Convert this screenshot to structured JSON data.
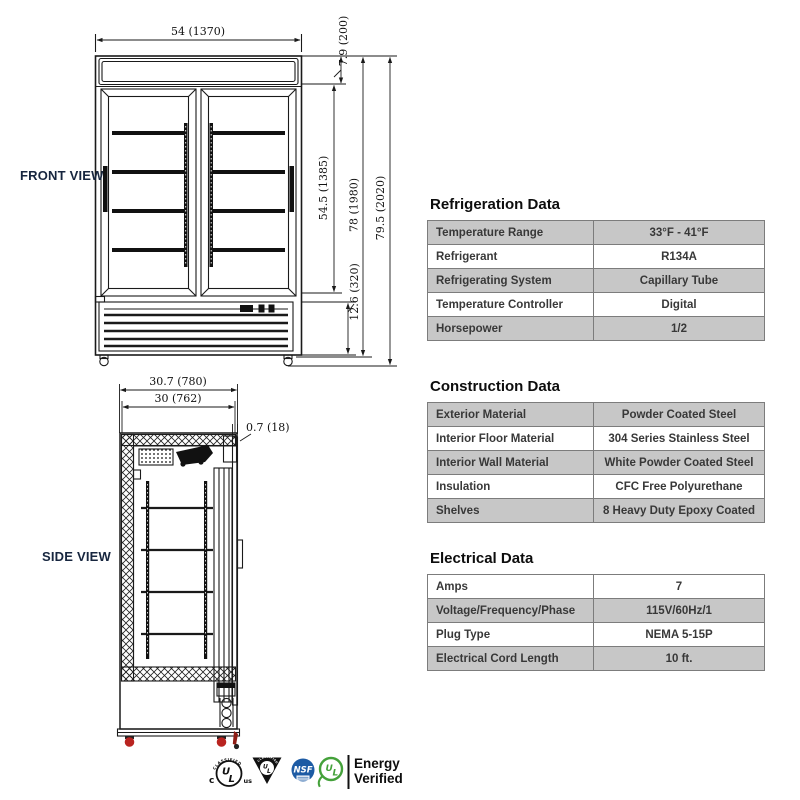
{
  "views": {
    "front": {
      "label": "FRONT VIEW",
      "dims": {
        "width": "54 (1370)",
        "header_height": "7.9 (200)",
        "door_section_height": "54.5 (1385)",
        "cabinet_height": "78 (1980)",
        "overall_height": "79.5 (2020)",
        "bottom_section_height": "12.6 (320)"
      }
    },
    "side": {
      "label": "SIDE VIEW",
      "dims": {
        "overall_depth": "30.7 (780)",
        "body_depth": "30 (762)",
        "door_thickness": "0.7 (18)"
      }
    }
  },
  "tables": [
    {
      "title": "Refrigeration Data",
      "rows": [
        {
          "label": "Temperature Range",
          "value": "33°F - 41°F"
        },
        {
          "label": "Refrigerant",
          "value": "R134A"
        },
        {
          "label": "Refrigerating System",
          "value": "Capillary Tube"
        },
        {
          "label": "Temperature Controller",
          "value": "Digital"
        },
        {
          "label": "Horsepower",
          "value": "1/2"
        }
      ]
    },
    {
      "title": "Construction Data",
      "rows": [
        {
          "label": "Exterior Material",
          "value": "Powder Coated Steel"
        },
        {
          "label": "Interior Floor Material",
          "value": "304 Series Stainless Steel"
        },
        {
          "label": "Interior Wall Material",
          "value": "White Powder Coated Steel"
        },
        {
          "label": "Insulation",
          "value": "CFC Free Polyurethane"
        },
        {
          "label": "Shelves",
          "value": "8 Heavy Duty Epoxy Coated"
        }
      ]
    },
    {
      "title": "Electrical Data",
      "rows": [
        {
          "label": "Amps",
          "value": "7"
        },
        {
          "label": "Voltage/Frequency/Phase",
          "value": "115V/60Hz/1"
        },
        {
          "label": "Plug Type",
          "value": "NEMA 5-15P"
        },
        {
          "label": "Electrical Cord Length",
          "value": "10 ft."
        }
      ]
    }
  ],
  "certifications": {
    "ul_classified": {
      "arc_text": "CLASSIFIED",
      "left": "c",
      "right": "us",
      "mark_u": "U",
      "mark_l": "L"
    },
    "ul_triangle": {
      "arc_text": "CLASSIFIED",
      "mark_u": "U",
      "mark_l": "L"
    },
    "nsf": {
      "mark": "NSF"
    },
    "ul_energy": {
      "mark_u": "U",
      "mark_l": "L",
      "line1": "Energy",
      "line2": "Verified"
    }
  },
  "colors": {
    "table_row_gray": "#c7c7c7",
    "table_border": "#7c7c7c",
    "nsf_blue": "#1d5ba4",
    "ul_green": "#44a13a",
    "caster_red": "#b92420",
    "view_label_navy": "#17263f"
  }
}
